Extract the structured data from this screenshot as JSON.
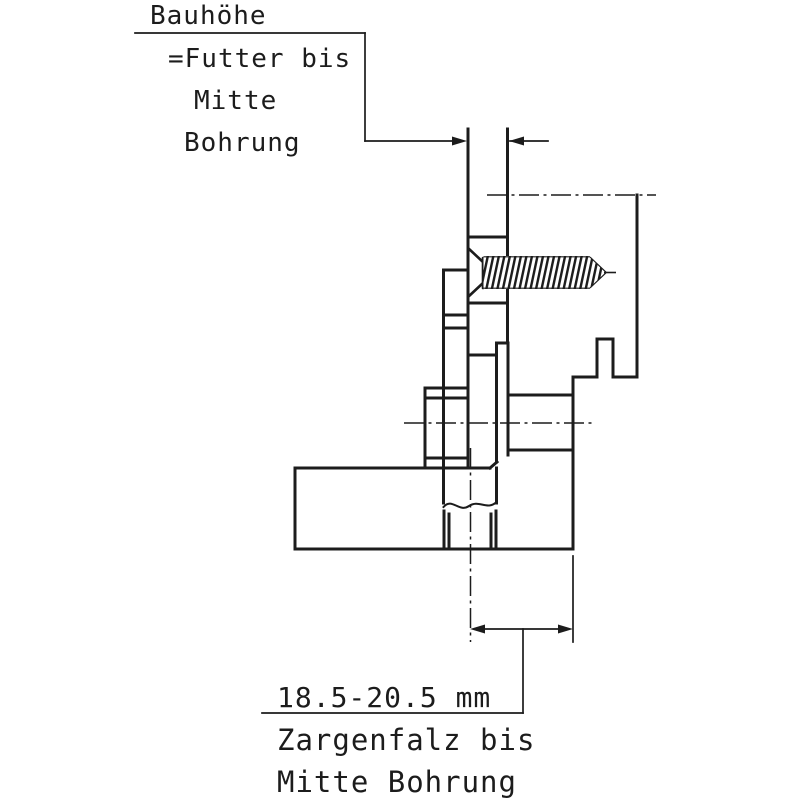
{
  "page": {
    "background_color": "#ffffff",
    "line_color": "#1c1c1c"
  },
  "annotations": {
    "top": {
      "title": "Bauhöhe",
      "line1": "=Futter bis",
      "line2": "Mitte",
      "line3": "Bohrung"
    },
    "bottom": {
      "value": "18.5-20.5 mm",
      "line1": "Zargenfalz bis",
      "line2": "Mitte Bohrung"
    }
  }
}
